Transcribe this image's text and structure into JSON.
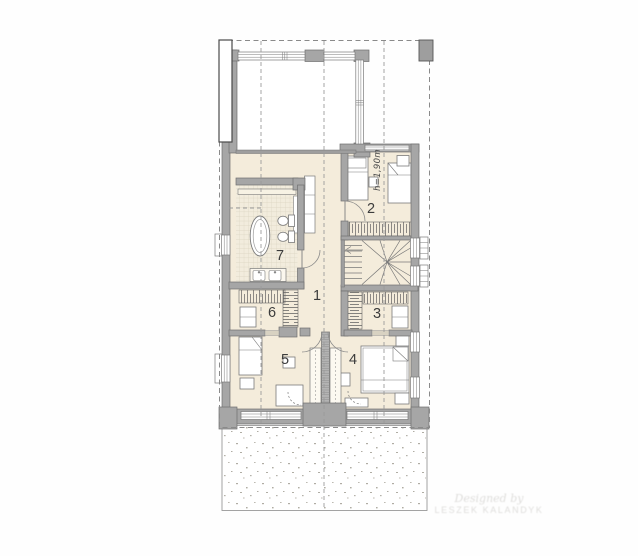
{
  "plan": {
    "rooms": [
      {
        "number": "1"
      },
      {
        "number": "2"
      },
      {
        "number": "3"
      },
      {
        "number": "4"
      },
      {
        "number": "5"
      },
      {
        "number": "6"
      },
      {
        "number": "7"
      }
    ],
    "annotations": {
      "knee_wall_height": "h=1,90m"
    },
    "watermark": {
      "line1": "Designed by",
      "line2": "LESZEK KALANDYK"
    },
    "colors": {
      "wall_fill": "#a6a6a6",
      "wall_edge": "#707070",
      "floor": "#f4ecdb",
      "tile_floor": "#f2ecdd",
      "dash_line": "#999999",
      "furniture_fill": "#fcf9f1"
    }
  }
}
